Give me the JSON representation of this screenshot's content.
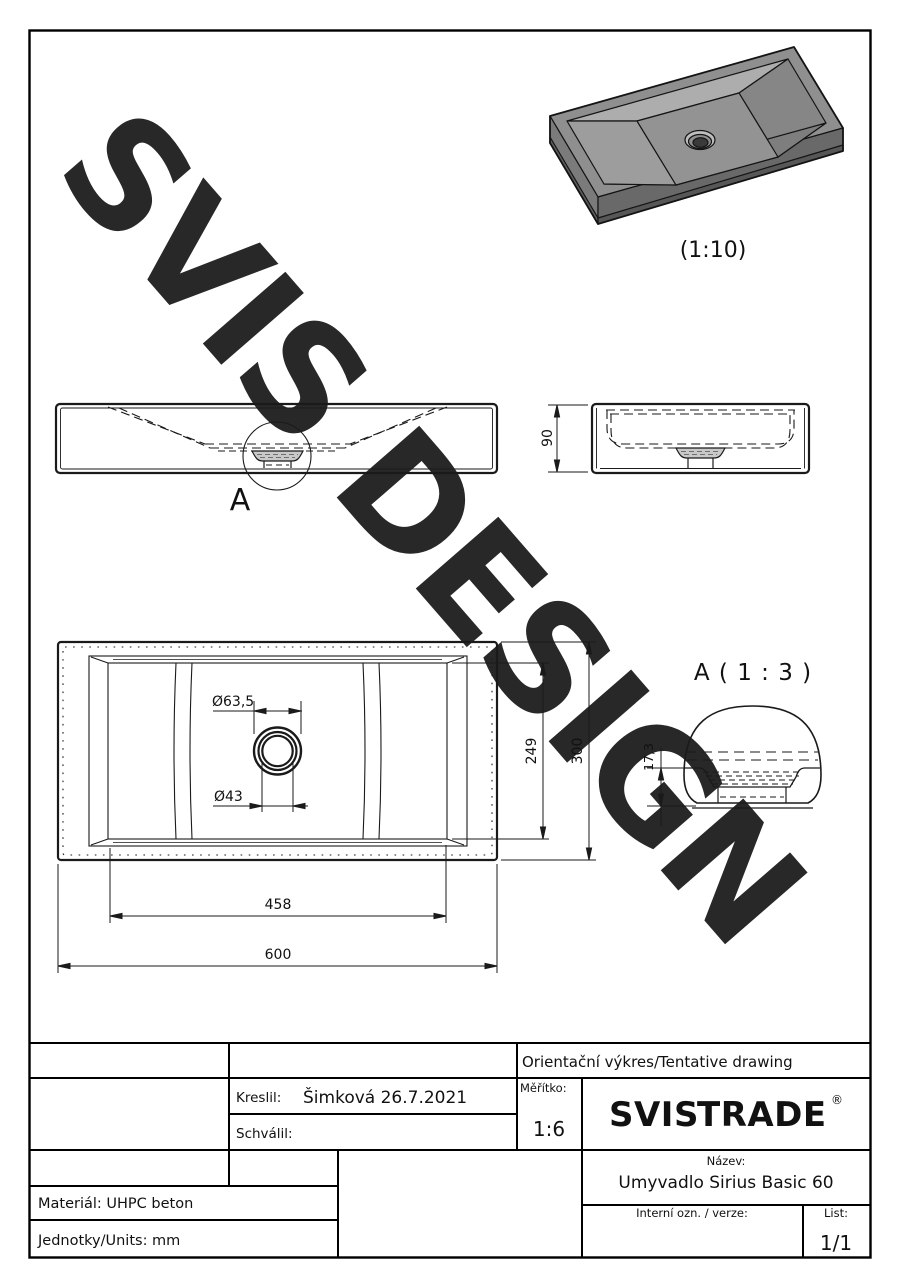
{
  "watermark": "SVIS DESIGN",
  "views": {
    "iso": {
      "scale_label": "(1:10)"
    },
    "front": {
      "detail_marker": "A"
    },
    "side": {
      "height_dim": "90"
    },
    "top": {
      "drain_outer_dim": "Ø63,5",
      "drain_inner_dim": "Ø43",
      "inner_depth_dim": "249",
      "outer_depth_dim": "300",
      "inner_width_dim": "458",
      "outer_width_dim": "600"
    },
    "detail": {
      "title": "A ( 1 : 3 )",
      "depth_dim": "17,3"
    }
  },
  "title_block": {
    "tentative": "Orientační výkres/Tentative drawing",
    "kreslil_label": "Kreslil:",
    "kreslil_value": "Šimková 26.7.2021",
    "schvalil_label": "Schválil:",
    "meritko_label": "Měřítko:",
    "meritko_value": "1:6",
    "logo": {
      "part1": "SVIS",
      "part2": "TRADE",
      "reg": "®",
      "accent": "#F2A900",
      "dark": "#161616"
    },
    "nazev_label": "Název:",
    "nazev_value": "Umyvadlo Sirius Basic 60",
    "interni_label": "Interní ozn. / verze:",
    "list_label": "List:",
    "list_value": "1/1",
    "material": "Materiál: UHPC beton",
    "units": "Jednotky/Units: mm"
  }
}
